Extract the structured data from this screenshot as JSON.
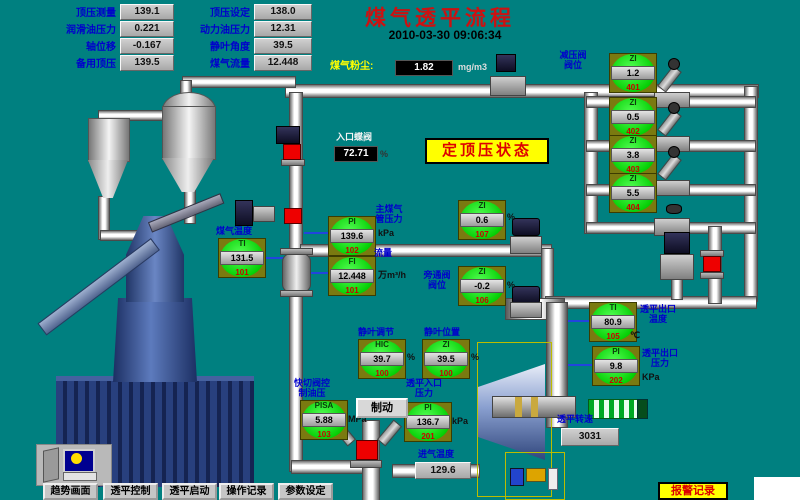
{
  "header": {
    "title": "煤气透平流程",
    "timestamp": "2010-03-30 09:06:34"
  },
  "status_banner": {
    "text": "定顶压状态"
  },
  "top_panel": {
    "rows": [
      {
        "label_left": "顶压测量",
        "value_left": "139.1",
        "label_right": "顶压设定",
        "value_right": "138.0"
      },
      {
        "label_left": "润滑油压力",
        "value_left": "0.221",
        "label_right": "动力油压力",
        "value_right": "12.31"
      },
      {
        "label_left": "轴位移",
        "value_left": "-0.167",
        "label_right": "静叶角度",
        "value_right": "39.5"
      },
      {
        "label_left": "备用顶压",
        "value_left": "139.5",
        "label_right": "煤气流量",
        "value_right": "12.448"
      }
    ]
  },
  "dust_meter": {
    "label": "煤气粉尘:",
    "value": "1.82",
    "unit": "mg/m3"
  },
  "inlet_valve": {
    "label": "入口蝶阀",
    "value": "72.71",
    "unit": "%"
  },
  "valve_group": {
    "label": "减压阀阀位"
  },
  "gauges": [
    {
      "type": "ZI",
      "value": "1.2",
      "tag": "401"
    },
    {
      "type": "ZI",
      "value": "0.5",
      "tag": "402"
    },
    {
      "type": "ZI",
      "value": "3.8",
      "tag": "403"
    },
    {
      "type": "ZI",
      "value": "5.5",
      "tag": "404"
    },
    {
      "type": "ZI",
      "value": "0.6",
      "tag": "107",
      "unit": "%"
    },
    {
      "type": "ZI",
      "value": "-0.2",
      "tag": "106",
      "unit": "%",
      "label": "旁通阀阀位"
    },
    {
      "type": "PI",
      "value": "139.6",
      "tag": "102",
      "unit": "kPa",
      "label": "主煤气管压力"
    },
    {
      "type": "FI",
      "value": "12.448",
      "tag": "101",
      "unit": "万m³/h",
      "label": "流量"
    },
    {
      "type": "TI",
      "value": "131.5",
      "tag": "101",
      "label": "煤气温度"
    },
    {
      "type": "HIC",
      "value": "39.7",
      "tag": "100",
      "unit": "%",
      "label": "静叶调节"
    },
    {
      "type": "ZI",
      "value": "39.5",
      "tag": "100",
      "unit": "%",
      "label": "静叶位置"
    },
    {
      "type": "PISA",
      "value": "5.88",
      "tag": "103",
      "unit": "MPa",
      "label": "快切阀控制油压"
    },
    {
      "type": "PI",
      "value": "136.7",
      "tag": "201",
      "unit": "kPa",
      "label": "透平入口压力"
    },
    {
      "type": "TI",
      "value": "80.9",
      "tag": "105",
      "unit": "℃",
      "label": "透平出口温度"
    },
    {
      "type": "PI",
      "value": "9.8",
      "tag": "202",
      "unit": "KPa",
      "label": "透平出口压力"
    }
  ],
  "readouts": {
    "intake_temp": {
      "label": "进气温度",
      "value": "129.6"
    },
    "turbine_speed": {
      "label": "透平转速",
      "value": "3031"
    }
  },
  "controls": {
    "brake_button": "制动"
  },
  "nav": {
    "buttons": [
      "趋势画面",
      "透平控制",
      "透平启动",
      "操作记录",
      "参数设定"
    ],
    "alarm_button": "报警记录"
  },
  "colors": {
    "background": "#008080",
    "banner_bg": "#ffff00",
    "banner_text": "#dd0000",
    "gauge_green": "#22ee22",
    "tag_red": "#cc0000",
    "label_blue": "#0000cc"
  }
}
